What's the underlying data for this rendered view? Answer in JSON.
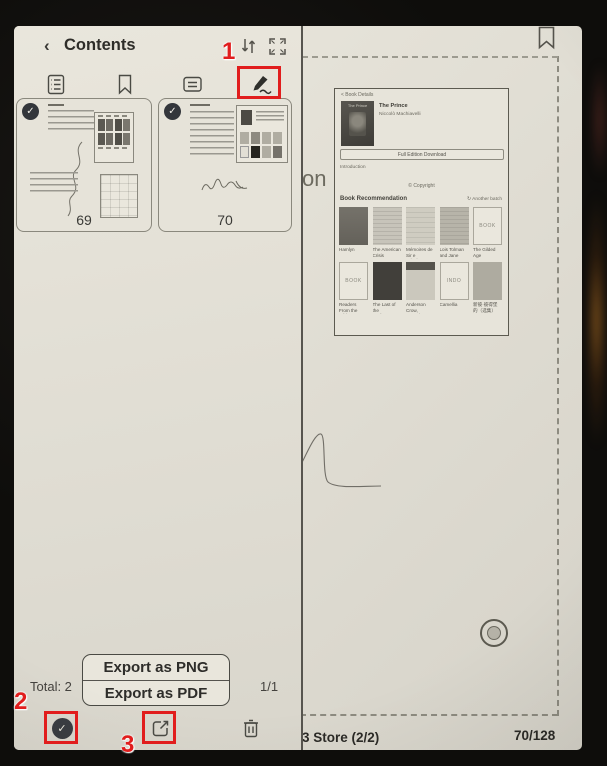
{
  "callouts": {
    "step1": "1",
    "step2": "2",
    "step3": "3"
  },
  "icons": {
    "check": "✓",
    "back_chevron": "‹"
  },
  "panel": {
    "title": "Contents",
    "header_icons": [
      "sort-icon",
      "fullscreen-icon"
    ],
    "tab_icons": [
      "toc-icon",
      "bookmark-icon",
      "annotation-icon",
      "scribble-icon"
    ],
    "active_tab": "scribble",
    "thumbnails": [
      {
        "page": "69",
        "selected": true
      },
      {
        "page": "70",
        "selected": true
      }
    ],
    "total_label": "Total: 2",
    "pager": "1/1",
    "export_menu": [
      "Export as PNG",
      "Export as PDF"
    ],
    "footer_icons": [
      "select-all-icon",
      "share-icon",
      "delete-icon"
    ]
  },
  "reader": {
    "corner_icon": "bookmark-icon",
    "page_text_fragment": "on",
    "store_bar": {
      "left": "3 Store (2/2)",
      "right": "70/128"
    },
    "book_detail": {
      "back_label": "< Book Details",
      "cover_text": "The Prince",
      "title": "The Prince",
      "author": "Niccolò Machiavelli",
      "download_label": "Full Edition Download",
      "intro_label": "Introduction",
      "copyright_label": "© Copyright",
      "rec_title": "Book Recommendation",
      "another_batch": "↻ Another batch",
      "books": [
        {
          "title": "Hamlyn",
          "variant": "dark",
          "cover_text": ""
        },
        {
          "title": "The American Crisis",
          "variant": "lines",
          "cover_text": ""
        },
        {
          "title": "Mémoires de Sir e Principes",
          "variant": "paper",
          "cover_text": ""
        },
        {
          "title": "Lois Tolman and Jane Hustage",
          "variant": "gray",
          "cover_text": ""
        },
        {
          "title": "The Gilded Age",
          "variant": "outline",
          "cover_text": "BOOK"
        },
        {
          "title": "Readers From the White",
          "variant": "outline",
          "cover_text": "BOOK"
        },
        {
          "title": "The Last of the Bushrangers…",
          "variant": "dark2",
          "cover_text": ""
        },
        {
          "title": "Anderson Crow, Detective",
          "variant": "header",
          "cover_text": ""
        },
        {
          "title": "Camellia",
          "variant": "logo",
          "cover_text": "INDO"
        },
        {
          "title": "新彼·彼得堡的（选集）",
          "variant": "gray2",
          "cover_text": ""
        }
      ]
    }
  },
  "colors": {
    "callout_red": "#e11d1d",
    "eink_bg": "#e1ded4",
    "ink": "#3a3a36"
  }
}
